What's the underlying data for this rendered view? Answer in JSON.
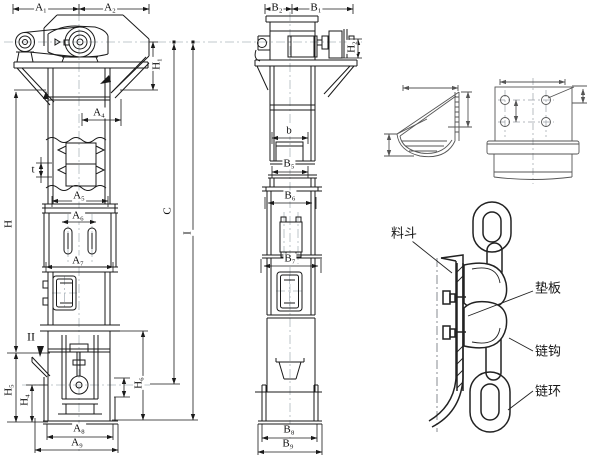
{
  "drawing_title": "bucket elevator general arrangement drawing",
  "front_view": {
    "a1": "A₁",
    "a2": "A₂",
    "a4": "A₄",
    "a5": "A₅",
    "a6": "A₆",
    "a7": "A₇",
    "a8": "A₈",
    "a9": "A₉",
    "h": "H",
    "h1": "H₁",
    "h4": "H₄",
    "h5": "H₅",
    "h6": "H₆",
    "c": "C",
    "i": "I",
    "t": "t",
    "section_mark": "II"
  },
  "side_view": {
    "b1": "B₁",
    "b2": "B₂",
    "b5": "B₅",
    "b6": "B₆",
    "b7": "B₇",
    "b8": "B₈",
    "b9": "B₉",
    "b": "b",
    "h2": "H₂"
  },
  "chain_detail": {
    "bucket": "料斗",
    "pad_plate": "垫板",
    "chain_hook": "链钩",
    "chain_link": "链环"
  },
  "colors": {
    "line": "#1a1a1a",
    "detail_line": "#555555",
    "centerline": "#adb6bd",
    "background": "#ffffff"
  }
}
